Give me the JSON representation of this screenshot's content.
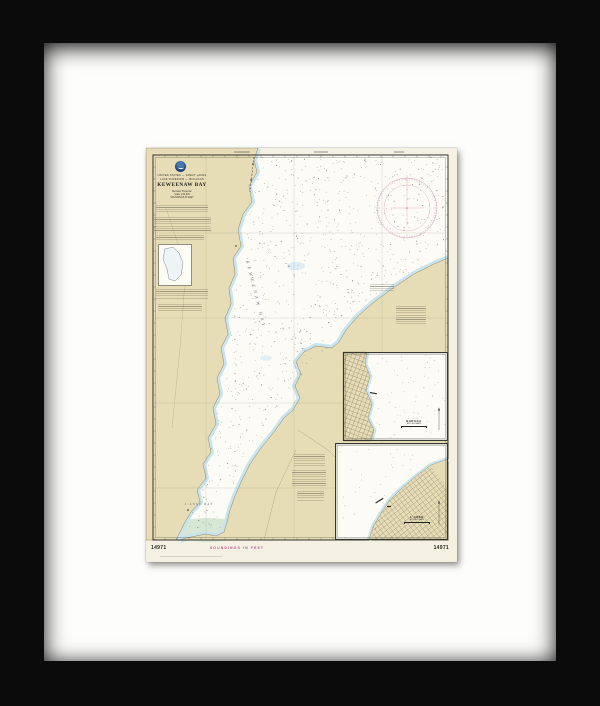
{
  "artwork": {
    "type": "framed nautical chart print",
    "frame_color": "#0b0b0b",
    "mat_color": "#fdfdfc"
  },
  "chart": {
    "agency_line1": "UNITED STATES — GREAT LAKES",
    "agency_line2": "LAKE SUPERIOR — MICHIGAN",
    "title": "KEWEENAW BAY",
    "subtitle_lines": [
      "Mercator Projection",
      "Scale 1:60,000",
      "SOUNDINGS IN FEET"
    ],
    "bottom_label": "SOUNDINGS IN FEET",
    "chart_number": "14971",
    "bay_label": "KEWEENAW BAY",
    "lanse_bay_label": "L'ANSE BAY",
    "insets": [
      {
        "title": "BARAGA",
        "subtitle": "MICHIGAN"
      },
      {
        "title": "L'ANSE",
        "subtitle": "MICHIGAN"
      }
    ],
    "colors": {
      "paper": "#f5f1e2",
      "land": "#e6dcb6",
      "water": "#fcfbf5",
      "shallow": "#c8e4ef",
      "magenta": "#c87ca8",
      "neatline": "#35352d"
    }
  },
  "geo": {
    "neatline": [
      7,
      7,
      295,
      385
    ],
    "west_coast": [
      [
        112,
        0
      ],
      [
        108,
        12
      ],
      [
        111,
        24
      ],
      [
        103,
        38
      ],
      [
        106,
        54
      ],
      [
        97,
        66
      ],
      [
        92,
        82
      ],
      [
        95,
        98
      ],
      [
        87,
        110
      ],
      [
        89,
        126
      ],
      [
        83,
        140
      ],
      [
        85,
        156
      ],
      [
        79,
        170
      ],
      [
        82,
        186
      ],
      [
        75,
        200
      ],
      [
        78,
        216
      ],
      [
        71,
        230
      ],
      [
        74,
        246
      ],
      [
        67,
        260
      ],
      [
        70,
        276
      ],
      [
        62,
        290
      ],
      [
        65,
        304
      ],
      [
        57,
        316
      ],
      [
        60,
        330
      ],
      [
        51,
        342
      ],
      [
        54,
        354
      ],
      [
        45,
        364
      ],
      [
        38,
        376
      ],
      [
        33,
        386
      ],
      [
        30,
        392
      ]
    ],
    "east_coast": [
      [
        302,
        110
      ],
      [
        288,
        116
      ],
      [
        268,
        126
      ],
      [
        247,
        140
      ],
      [
        228,
        154
      ],
      [
        212,
        168
      ],
      [
        200,
        182
      ],
      [
        193,
        194
      ],
      [
        186,
        200
      ],
      [
        170,
        198
      ],
      [
        158,
        204
      ],
      [
        150,
        214
      ],
      [
        155,
        226
      ],
      [
        149,
        238
      ],
      [
        154,
        250
      ],
      [
        147,
        262
      ],
      [
        138,
        270
      ],
      [
        128,
        284
      ],
      [
        115,
        300
      ],
      [
        104,
        316
      ],
      [
        96,
        332
      ],
      [
        89,
        348
      ],
      [
        84,
        362
      ],
      [
        81,
        374
      ],
      [
        78,
        384
      ],
      [
        70,
        388
      ],
      [
        60,
        386
      ],
      [
        50,
        388
      ],
      [
        40,
        390
      ],
      [
        34,
        392
      ]
    ],
    "left_limit": [
      [
        0,
        112
      ],
      [
        60,
        100
      ],
      [
        120,
        88
      ],
      [
        180,
        80
      ],
      [
        240,
        70
      ],
      [
        300,
        60
      ],
      [
        340,
        50
      ],
      [
        392,
        32
      ]
    ],
    "right_limit": [
      [
        0,
        300
      ],
      [
        108,
        300
      ],
      [
        140,
        245
      ],
      [
        170,
        210
      ],
      [
        200,
        186
      ],
      [
        238,
        150
      ],
      [
        270,
        136
      ],
      [
        300,
        114
      ],
      [
        332,
        95
      ],
      [
        362,
        84
      ],
      [
        385,
        78
      ]
    ],
    "graticule_x": [
      60,
      148,
      236
    ],
    "graticule_y": [
      85,
      170,
      255,
      340
    ],
    "compass": {
      "cx": 261,
      "cy": 60,
      "r": 30
    },
    "sounding_count": 750,
    "inset1": {
      "x": 197,
      "y": 204,
      "w": 105,
      "h": 89,
      "land": [
        [
          0,
          0
        ],
        [
          24,
          0
        ],
        [
          22,
          12
        ],
        [
          27,
          24
        ],
        [
          23,
          38
        ],
        [
          29,
          52
        ],
        [
          25,
          66
        ],
        [
          31,
          78
        ],
        [
          28,
          89
        ],
        [
          0,
          89
        ]
      ],
      "coast": [
        [
          24,
          0
        ],
        [
          22,
          12
        ],
        [
          27,
          24
        ],
        [
          23,
          38
        ],
        [
          29,
          52
        ],
        [
          25,
          66
        ],
        [
          31,
          78
        ],
        [
          28,
          89
        ]
      ]
    },
    "inset2": {
      "x": 189,
      "y": 295,
      "w": 113,
      "h": 97,
      "land": [
        [
          113,
          16
        ],
        [
          96,
          22
        ],
        [
          80,
          34
        ],
        [
          66,
          46
        ],
        [
          54,
          58
        ],
        [
          45,
          72
        ],
        [
          38,
          84
        ],
        [
          34,
          97
        ],
        [
          113,
          97
        ]
      ],
      "coast": [
        [
          113,
          16
        ],
        [
          96,
          22
        ],
        [
          80,
          34
        ],
        [
          66,
          46
        ],
        [
          54,
          58
        ],
        [
          45,
          72
        ],
        [
          38,
          84
        ],
        [
          34,
          97
        ]
      ]
    },
    "locator_lake": "6,4 14,2 20,8 24,18 22,30 16,36 10,34 8,24 4,14"
  }
}
